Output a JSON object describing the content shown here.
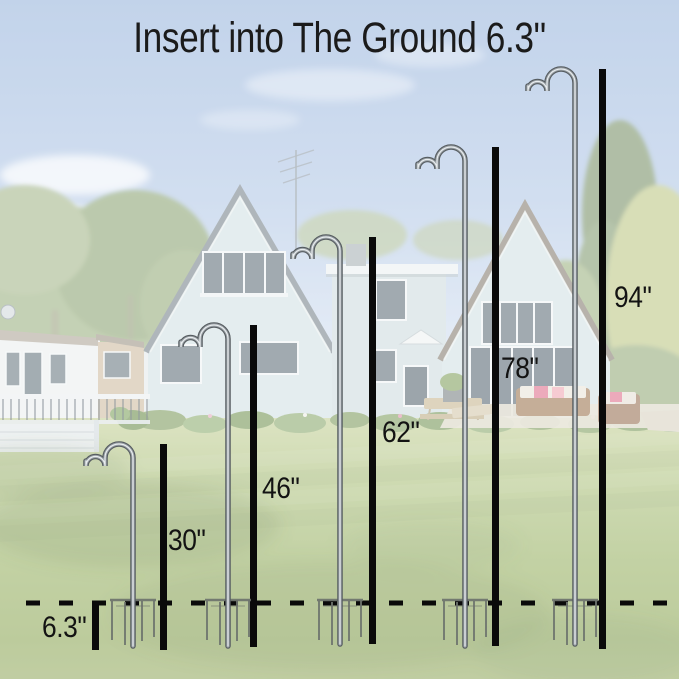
{
  "title": "Insert into The Ground 6.3\"",
  "measurements": {
    "insert_depth_label": "6.3\"",
    "insert_depth_inches": 6.3,
    "hook_heights": [
      {
        "label": "30\"",
        "inches": 30
      },
      {
        "label": "46\"",
        "inches": 46
      },
      {
        "label": "62\"",
        "inches": 62
      },
      {
        "label": "78\"",
        "inches": 78
      },
      {
        "label": "94\"",
        "inches": 94
      }
    ]
  },
  "colors": {
    "annotation": "#111111",
    "pole_chrome": "#9aa1a6"
  }
}
